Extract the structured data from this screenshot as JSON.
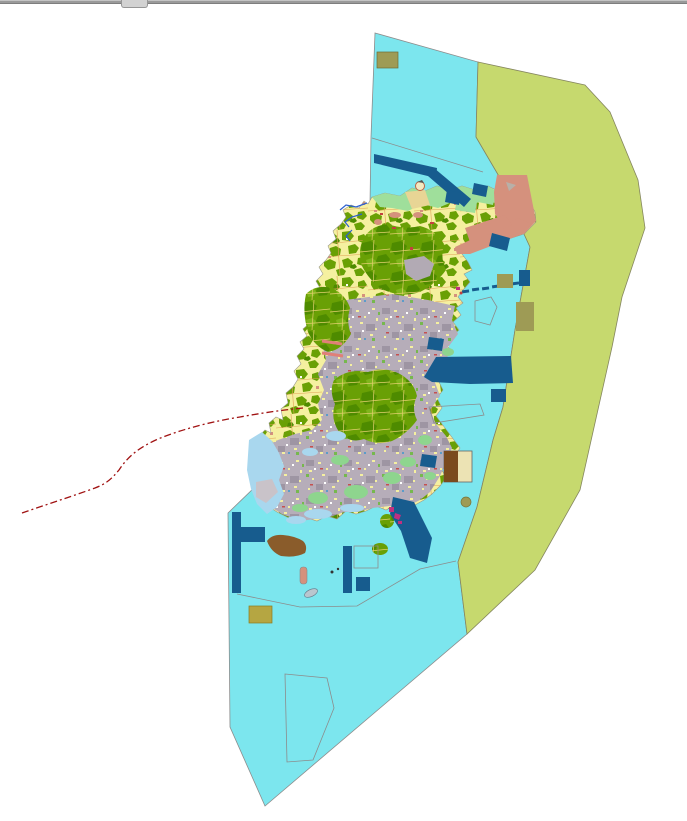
{
  "window": {
    "chrome_bar": {
      "bar_color": "#9a9a9a",
      "tab_color": "#d2d2d2"
    }
  },
  "map": {
    "colors": {
      "sea_zone": "#7ce6ee",
      "coastal_strip_zone": "#c6d96e",
      "land_base": "#f5f0a0",
      "vegetation": "#69a005",
      "vegetation_dark": "#4e8b00",
      "urban_fabric": "#b6adb9",
      "shore_green": "#9fdf9b",
      "reclaimed_salmon": "#d5917d",
      "port_dark_blue": "#175c8e",
      "khaki_block": "#9e9b55",
      "khaki_block_alt": "#b5a642",
      "brown_area": "#8a5c2b",
      "brown_dark": "#7a4a1e",
      "tan_light": "#ece3b4",
      "shallow_water": "#a9d7ee",
      "beach_gray": "#c9c3c9",
      "beach_tan": "#e8d595",
      "boundary_line": "#8c8c8c",
      "zone_edge": "#85865f",
      "red_boundary_dashed": "#a01212",
      "stream_blue": "#2b5fd0",
      "pink_road": "#e08078",
      "magenta_detail": "#c03080",
      "gray_patch": "#b2aab4",
      "pale_green_patch": "#8ed58e"
    }
  }
}
